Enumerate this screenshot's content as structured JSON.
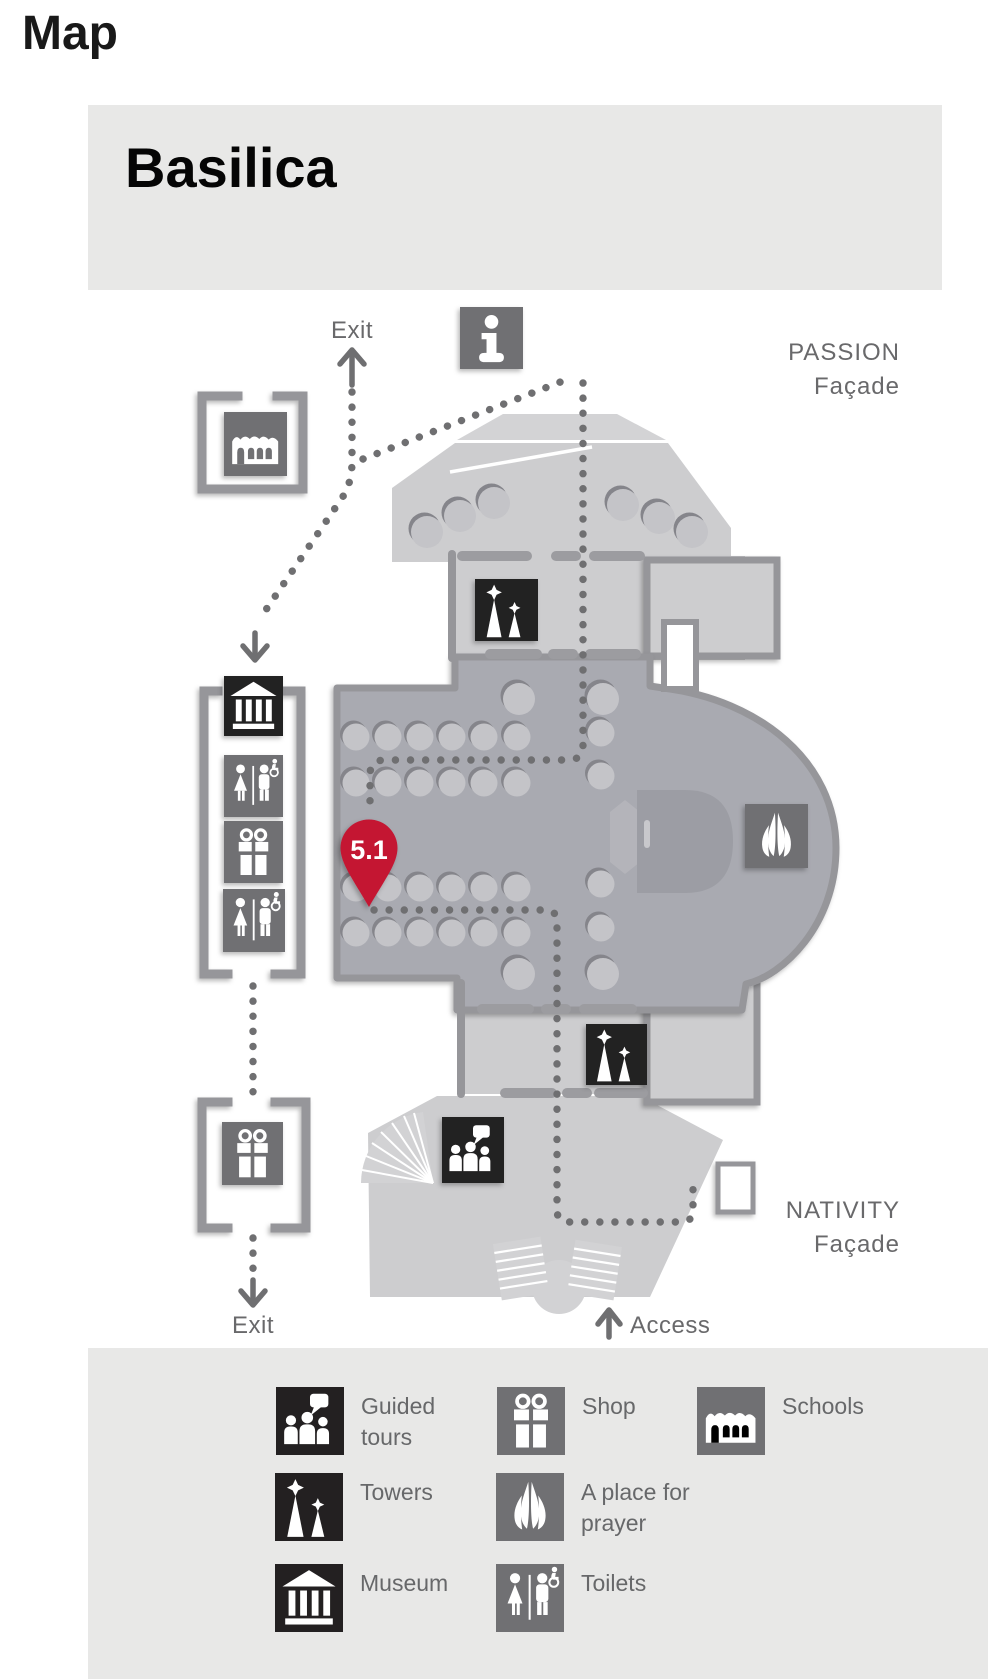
{
  "page": {
    "title": "Map"
  },
  "map": {
    "title": "Basilica",
    "labels": {
      "exit_top": "Exit",
      "exit_bottom": "Exit",
      "access": "Access",
      "passion": [
        "PASSION",
        "Façade"
      ],
      "nativity": [
        "NATIVITY",
        "Façade"
      ],
      "pin": "5.1"
    },
    "markers": [
      "information",
      "schools",
      "towers-passion",
      "museum",
      "toilets-upper",
      "shop-nave",
      "toilets-lower",
      "a-place-for-prayer",
      "towers-nativity",
      "guided-tours",
      "shop-exit",
      "location-pin-5.1"
    ]
  },
  "legend": {
    "items": [
      {
        "icon": "guided-tours",
        "label": "Guided tours",
        "variant": "black"
      },
      {
        "icon": "shop",
        "label": "Shop",
        "variant": "gray"
      },
      {
        "icon": "schools",
        "label": "Schools",
        "variant": "gray"
      },
      {
        "icon": "towers",
        "label": "Towers",
        "variant": "black"
      },
      {
        "icon": "prayer",
        "label": "A place for prayer",
        "variant": "gray"
      },
      {
        "icon": "museum",
        "label": "Museum",
        "variant": "black"
      },
      {
        "icon": "toilets",
        "label": "Toilets",
        "variant": "gray"
      }
    ]
  },
  "colors": {
    "panel_bg": "#e8e8e7",
    "floor_light": "#cdcdcf",
    "floor_steps": "#d3d3d5",
    "floor_interior": "#a9aab1",
    "wall": "#96969a",
    "column": "#c4c4c8",
    "route_dot": "#6f6f71",
    "icon_black": "#232021",
    "icon_gray": "#707073",
    "pin_red": "#c41432",
    "label_gray": "#69696b",
    "title_black": "#191919"
  }
}
